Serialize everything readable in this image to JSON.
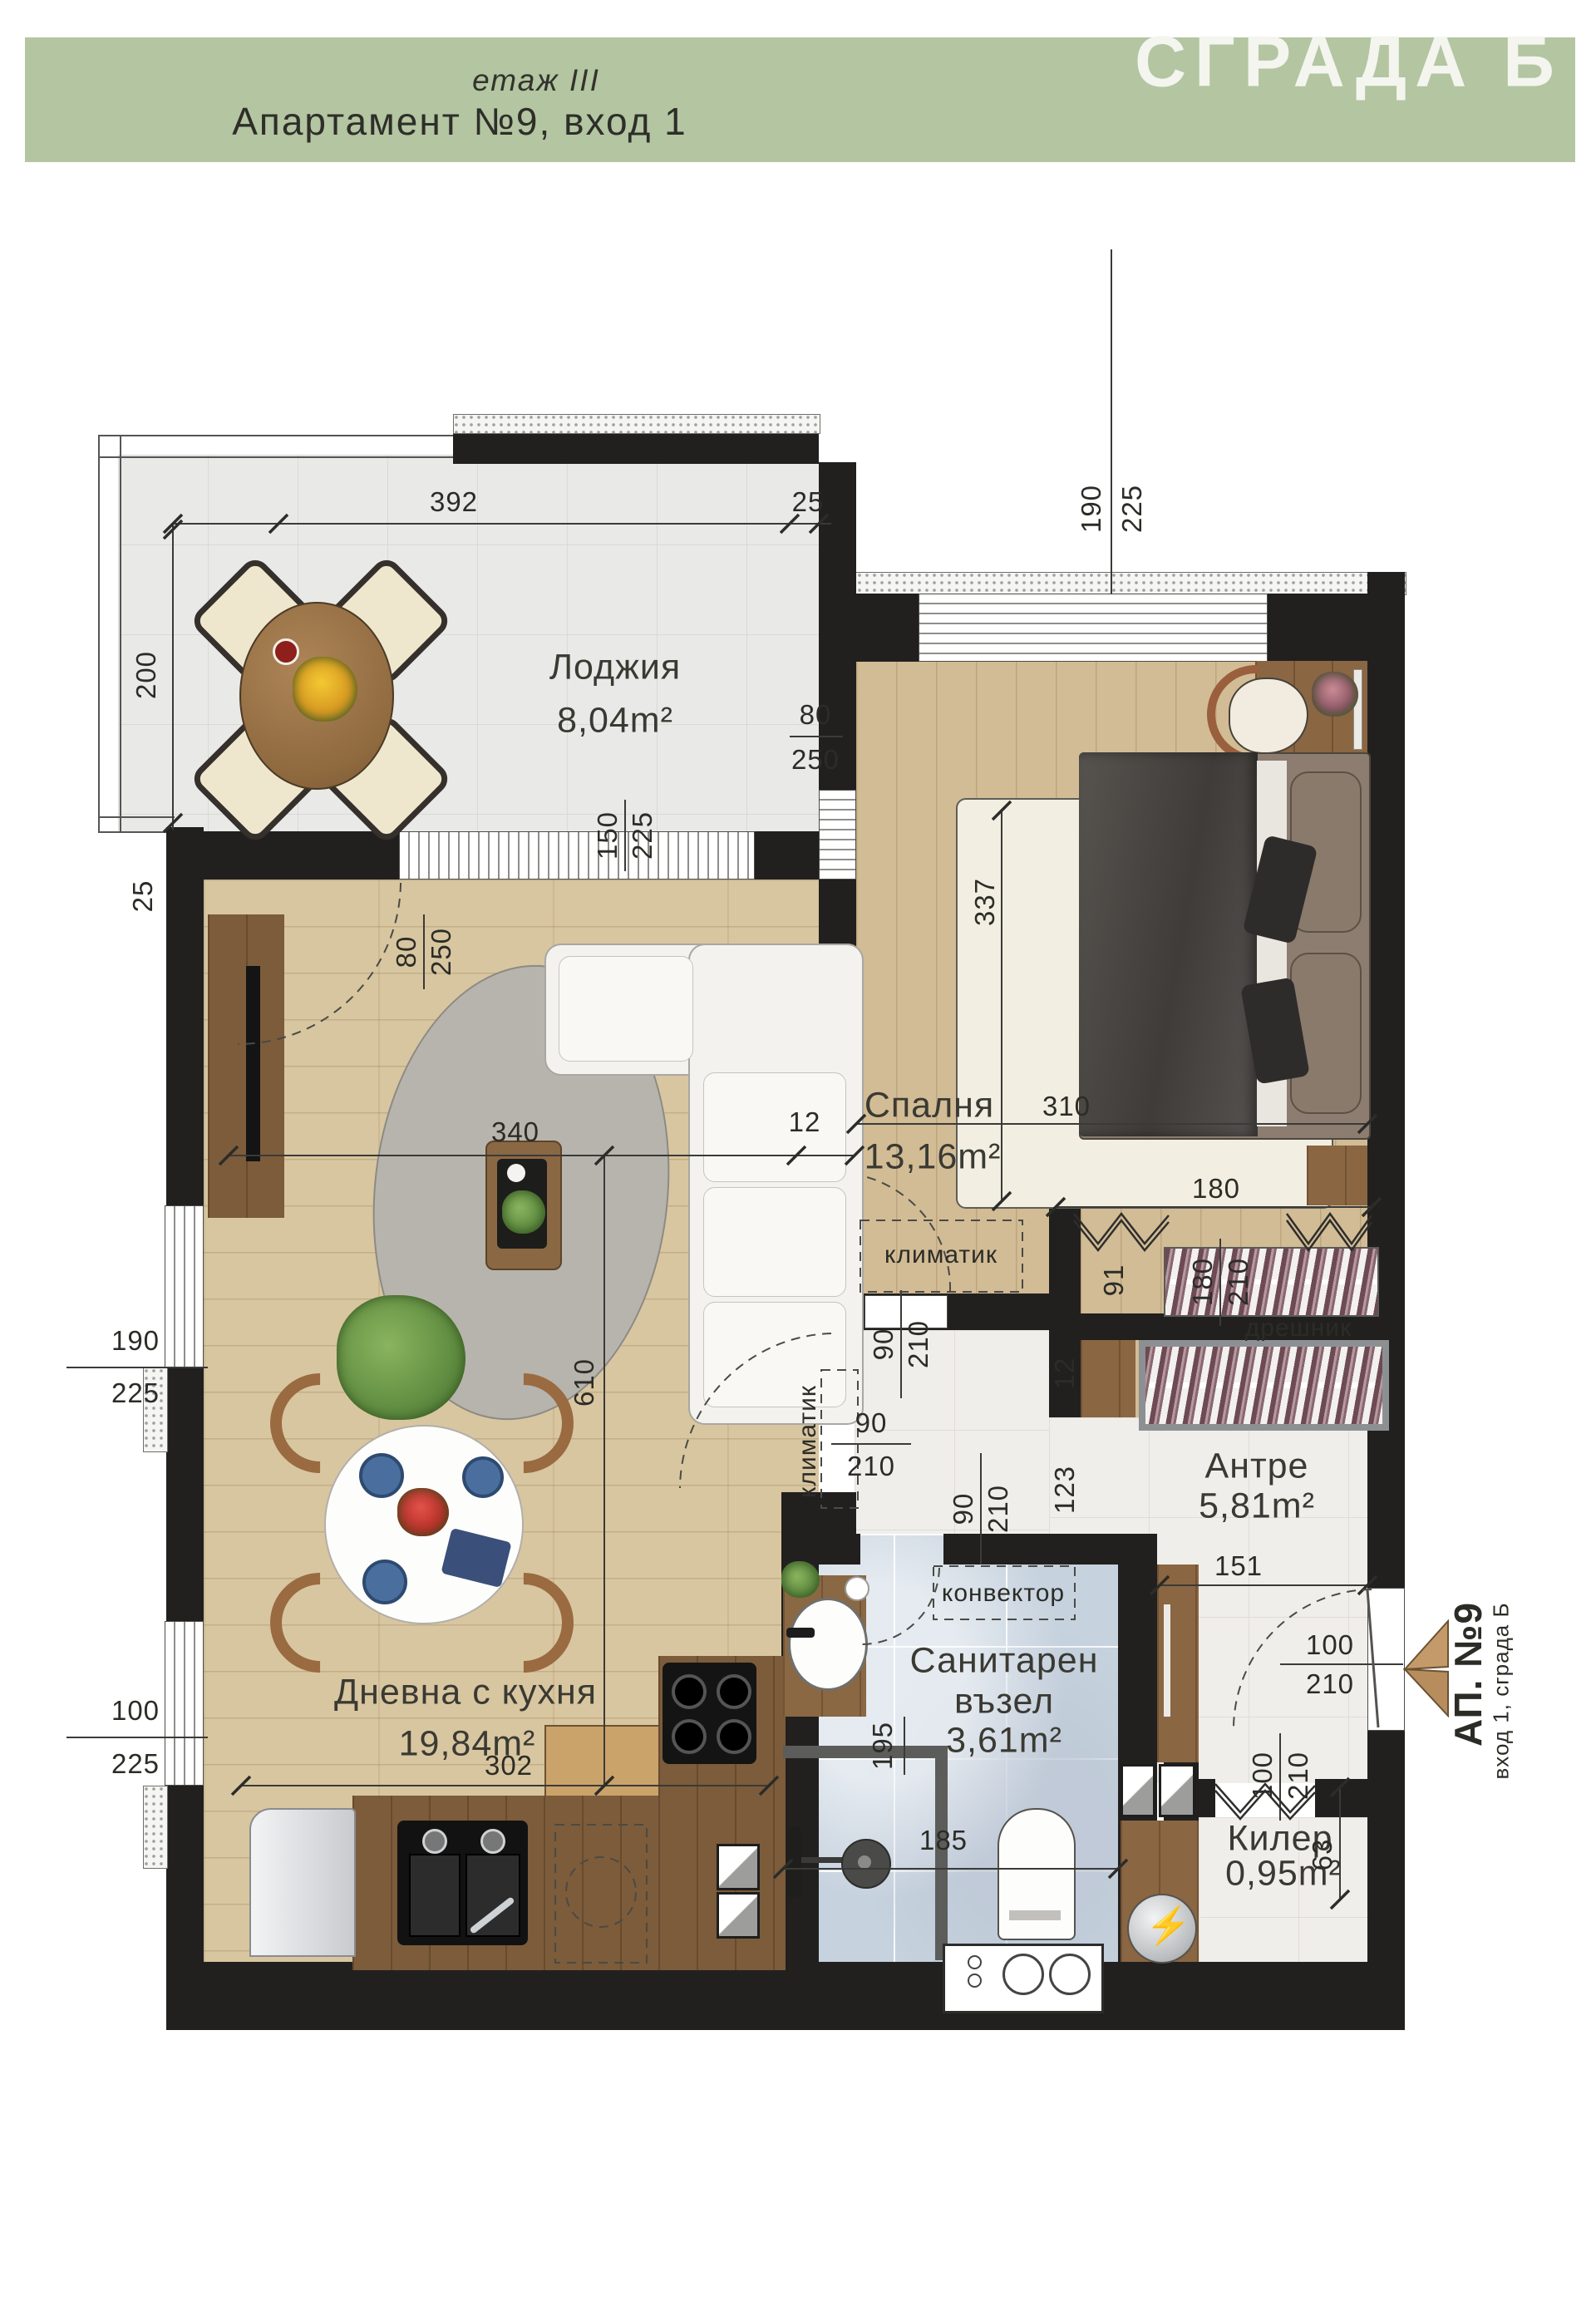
{
  "header": {
    "floor_label": "етаж III",
    "apartment_title": "Апартамент №9, вход 1",
    "building_badge": "СГРАДА Б"
  },
  "rooms": {
    "loggia": {
      "name": "Лоджия",
      "area": "8,04m²"
    },
    "bedroom": {
      "name": "Спалня",
      "area": "13,16m²"
    },
    "living_kitchen": {
      "name": "Дневна с кухня",
      "area": "19,84m²"
    },
    "hallway": {
      "name": "Антре",
      "area": "5,81m²"
    },
    "bathroom": {
      "name_line1": "Санитарен",
      "name_line2": "възел",
      "area": "3,61m²"
    },
    "storage": {
      "name": "Килер",
      "area": "0,95m²"
    },
    "wardrobe": {
      "name": "дрешник"
    }
  },
  "equipment": {
    "ac_bedroom": "климатик",
    "ac_living": "климатик",
    "convector": "конвектор"
  },
  "entrance": {
    "apartment": "АП. №9",
    "subtitle": "вход 1, сграда Б"
  },
  "dimensions": {
    "loggia_width": "392",
    "loggia_wall_top": "25",
    "loggia_depth": "200",
    "loggia_wall_left": "25",
    "bedroom_window_w": "190",
    "bedroom_window_h": "225",
    "corner_window_w": "80",
    "corner_window_h": "250",
    "loggia_window_w": "150",
    "loggia_window_h": "225",
    "terrace_window_w": "80",
    "terrace_window_h": "250",
    "bedroom_length": "337",
    "bedroom_width": "310",
    "living_width": "340",
    "wall_12": "12",
    "living_length": "610",
    "wardrobe_width": "180",
    "wardrobe_door_w": "180",
    "wardrobe_door_h": "210",
    "shelf_91": "91",
    "wall_12b": "12",
    "wall_123": "123",
    "left_window1_w": "190",
    "left_window1_h": "225",
    "left_window2_w": "100",
    "left_window2_h": "225",
    "bed_door_w": "90",
    "bed_door_h": "210",
    "liv_door_w": "90",
    "liv_door_h": "210",
    "bath_door_w": "90",
    "bath_door_h": "210",
    "hall_151": "151",
    "kitchen_302": "302",
    "bath_195": "195",
    "bath_185": "185",
    "entry_door_w": "100",
    "entry_door_h": "210",
    "storage_door_w": "100",
    "storage_door_h": "210",
    "storage_63": "63"
  },
  "palette": {
    "header_green": "#b3c5a1",
    "wall_black": "#21201f",
    "wood_light": "#d8c6a0",
    "wood_dark": "#7c5c3a",
    "bath_blue": "#c6d2de",
    "accent_arrow": "#c49a6a"
  }
}
